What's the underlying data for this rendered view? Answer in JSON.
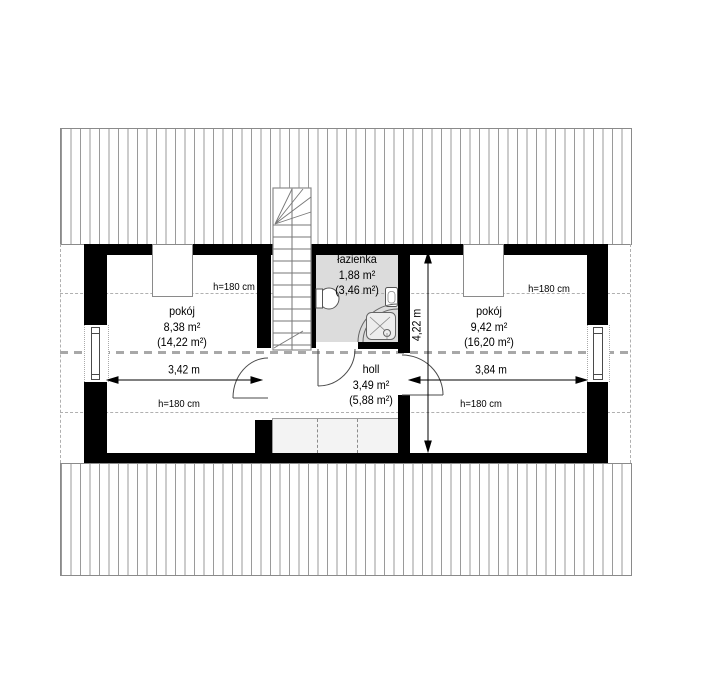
{
  "plan": {
    "title": "attic-floor-plan",
    "rooms": [
      {
        "id": "room-left",
        "name": "pokój",
        "area": "8,38 m²",
        "area_floor": "(14,22 m²)"
      },
      {
        "id": "bathroom",
        "name": "łazienka",
        "area": "1,88 m²",
        "area_floor": "(3,46 m²)"
      },
      {
        "id": "room-right",
        "name": "pokój",
        "area": "9,42 m²",
        "area_floor": "(16,20 m²)"
      },
      {
        "id": "hall",
        "name": "holl",
        "area": "3,49 m²",
        "area_floor": "(5,88 m²)"
      }
    ],
    "dimensions": {
      "left_room_width": "3,42 m",
      "right_room_width": "3,84 m",
      "interior_depth": "4,22 m"
    },
    "height_label": "h=180 cm",
    "colors": {
      "wall": "#000000",
      "bath": "#dcdcdc",
      "closet": "#f3f3f3",
      "hatch": "#9a9a9a",
      "dash": "#b0b0b0",
      "ridge": "#a8a8a8"
    }
  }
}
